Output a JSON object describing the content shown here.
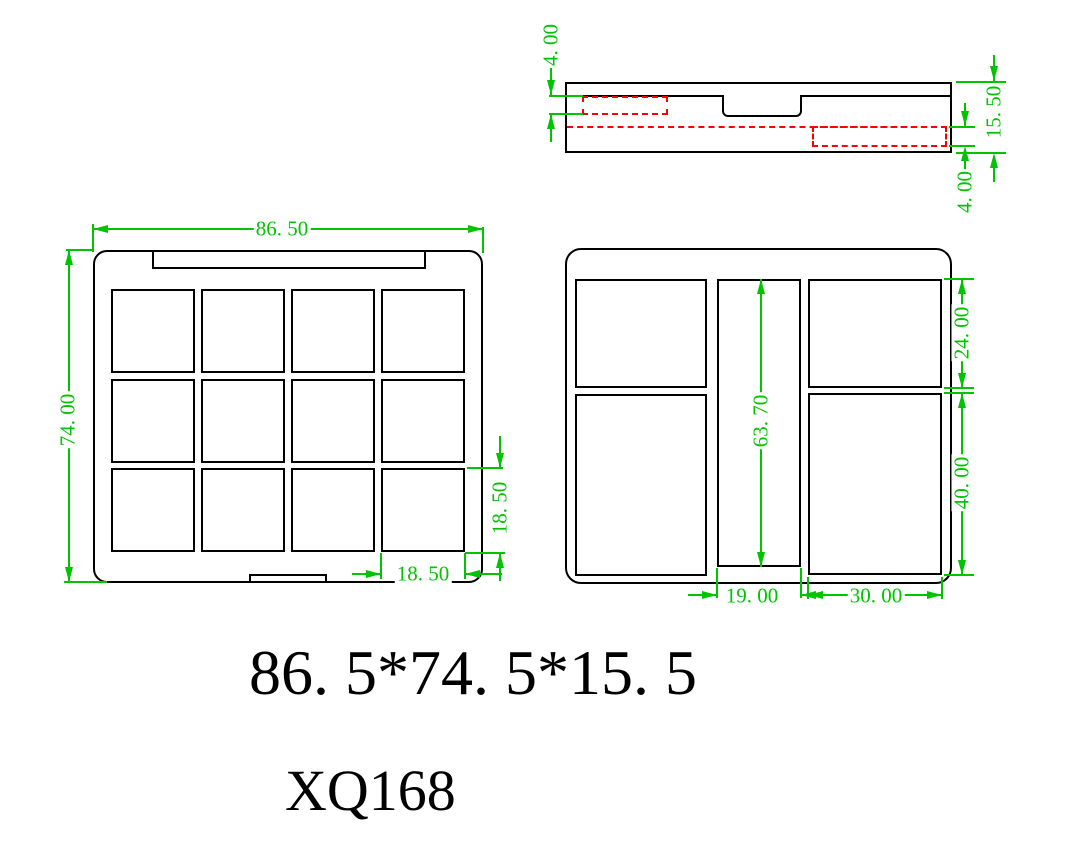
{
  "drawing": {
    "labels": {
      "overall_size": "86. 5*74. 5*15. 5",
      "model_code": "XQ168"
    },
    "colors": {
      "dimension_green": "#00c400",
      "hidden_line_red": "#ff0000",
      "outline_black": "#000000",
      "background": "#ffffff"
    },
    "dims": {
      "section": {
        "top_recess_depth": "4. 00",
        "total_height": "15. 50",
        "bottom_recess_depth": "4. 00"
      },
      "front": {
        "overall_width": "86. 50",
        "overall_height": "74. 00",
        "pan_height": "18. 50",
        "pan_width": "18. 50"
      },
      "base": {
        "center_channel_length": "63. 70",
        "top_right_pan_height": "24. 00",
        "bottom_right_pan_height": "40. 00",
        "center_channel_width": "19. 00",
        "right_pan_width": "30. 00"
      }
    }
  }
}
